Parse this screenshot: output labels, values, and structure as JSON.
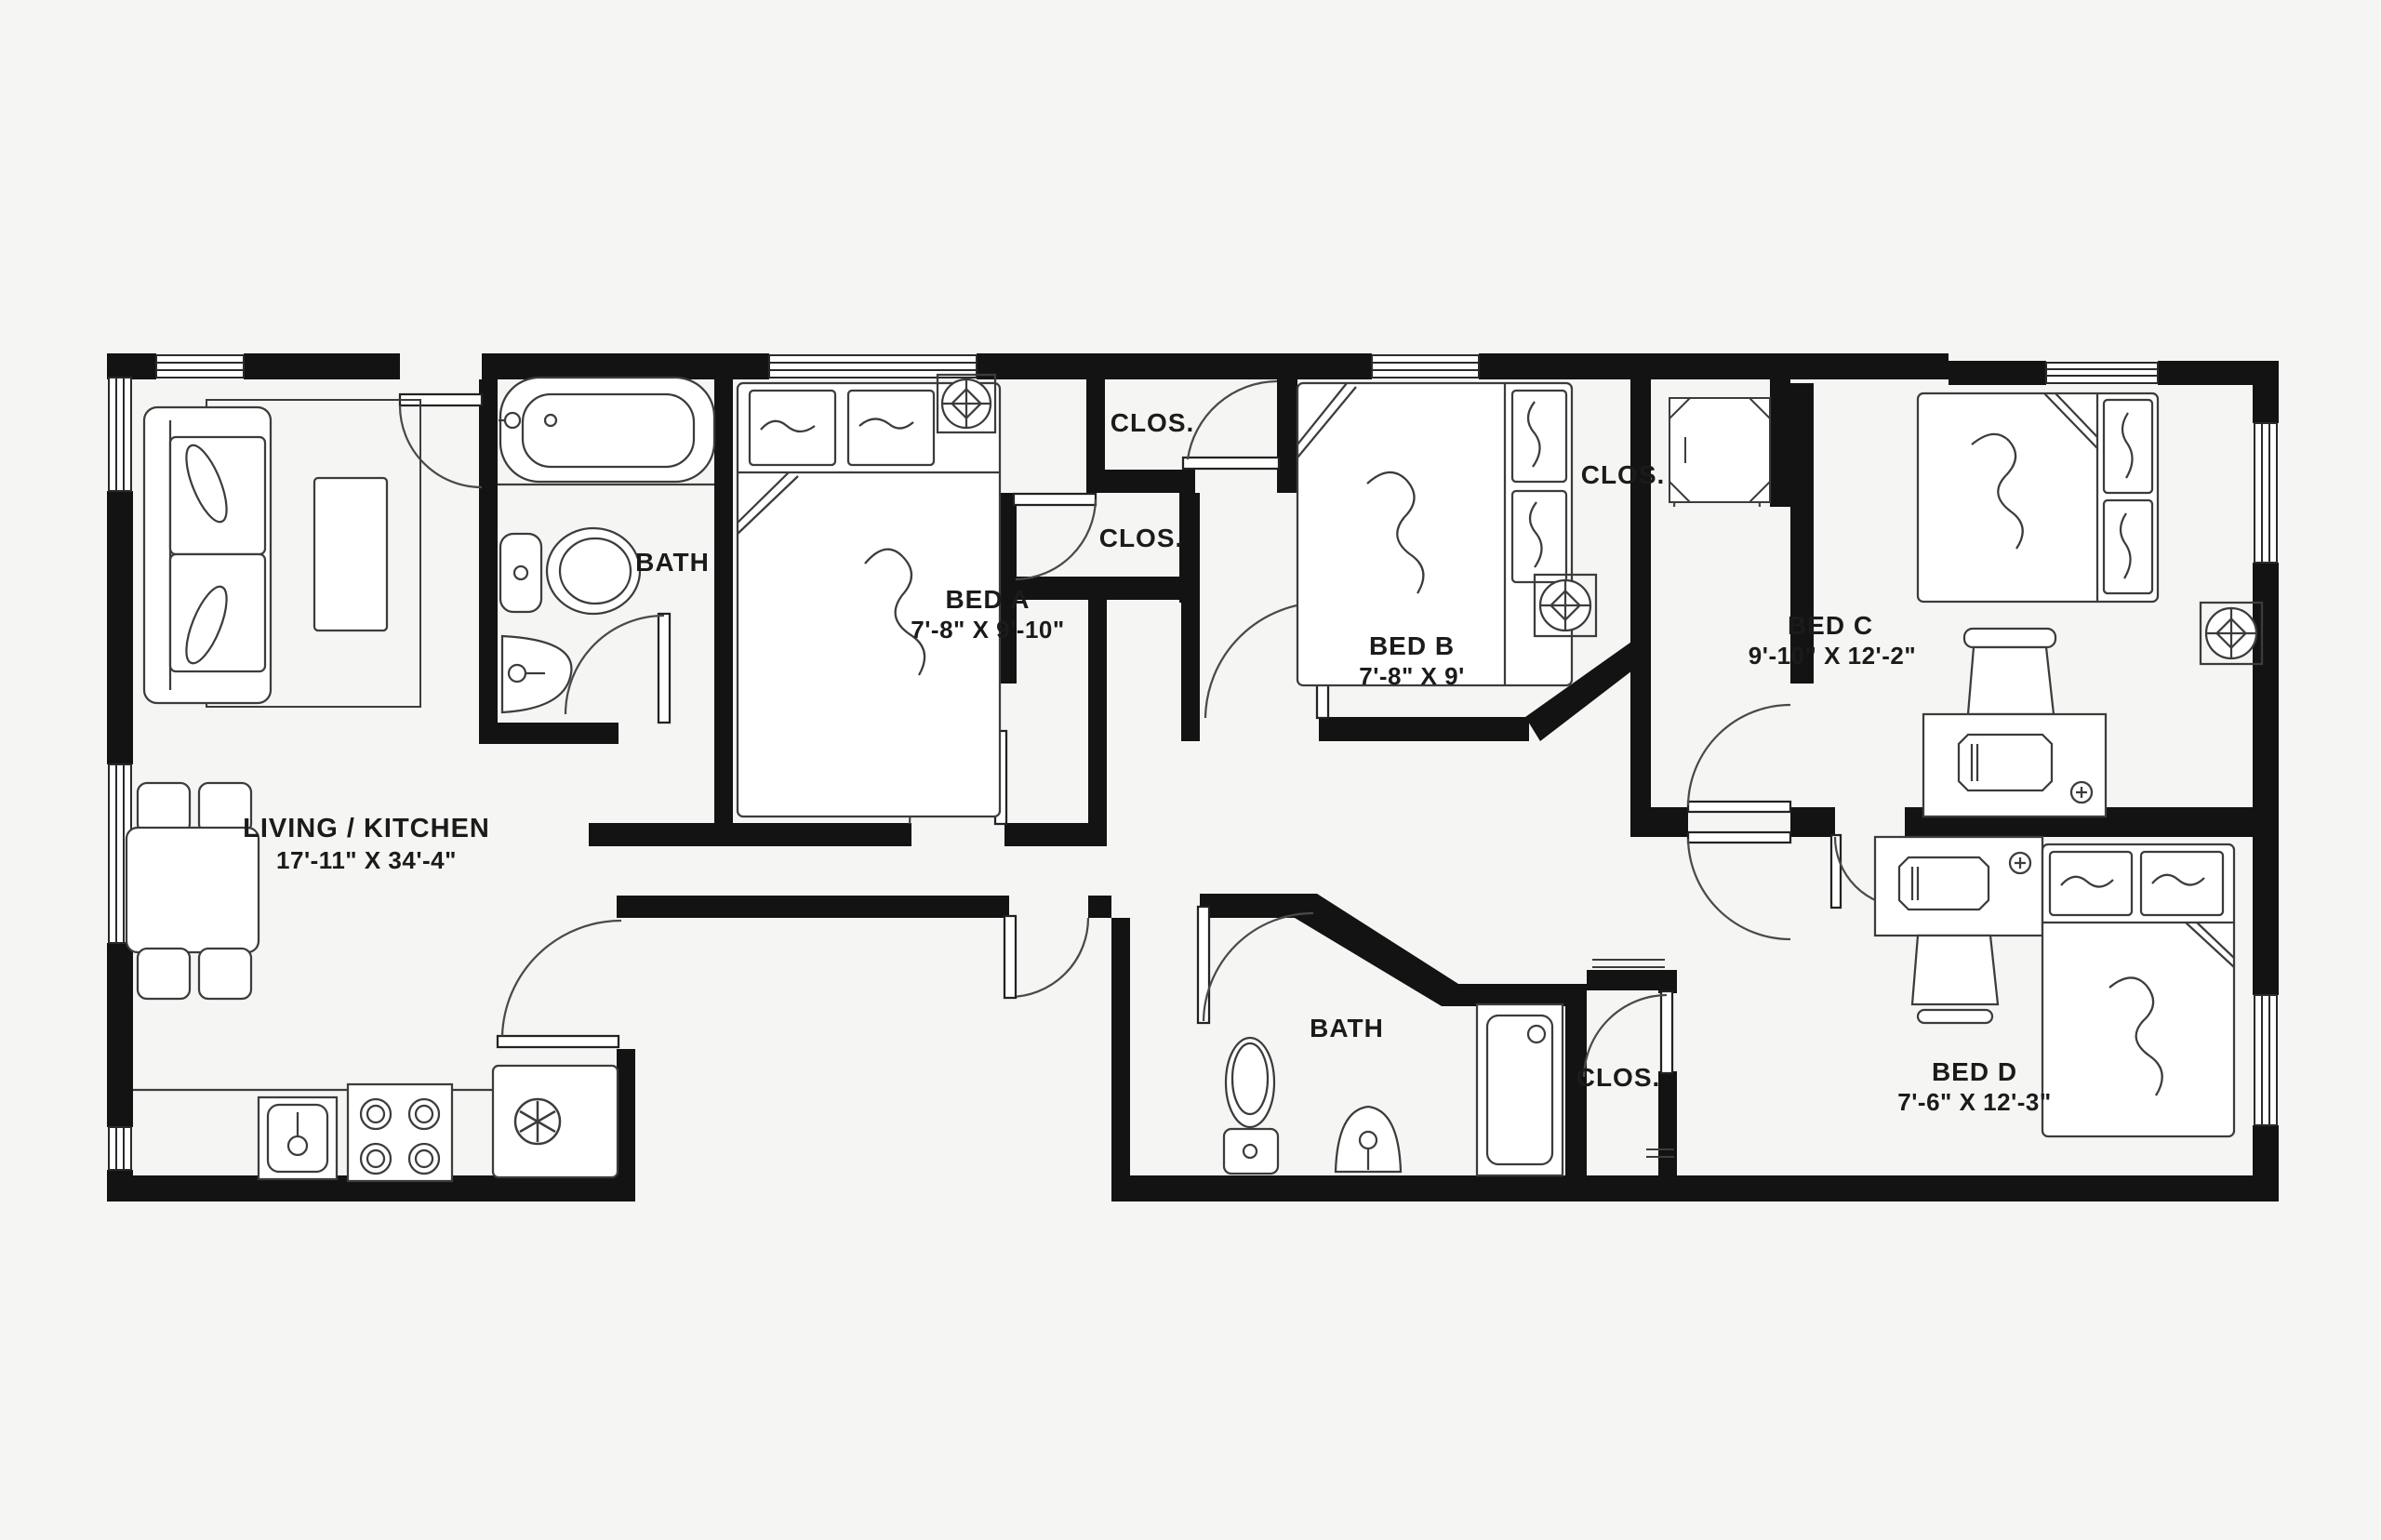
{
  "plan": {
    "title": "4-bedroom unit floor plan",
    "rooms": [
      {
        "name": "LIVING / KITCHEN",
        "dims": "17'-11\" X 34'-4\""
      },
      {
        "name": "BATH",
        "dims": ""
      },
      {
        "name": "BED A",
        "dims": "7'-8\" X 9'-10\""
      },
      {
        "name": "CLOS.",
        "dims": ""
      },
      {
        "name": "CLOS.",
        "dims": ""
      },
      {
        "name": "BED B",
        "dims": "7'-8\" X 9'"
      },
      {
        "name": "CLOS.",
        "dims": ""
      },
      {
        "name": "BED C",
        "dims": "9'-10\" X 12'-2\""
      },
      {
        "name": "BATH",
        "dims": ""
      },
      {
        "name": "CLOS.",
        "dims": ""
      },
      {
        "name": "BED D",
        "dims": "7'-6\" X 12'-3\""
      }
    ],
    "colors": {
      "wall": "#131313",
      "furniture_line": "#3c3c3c",
      "background": "#f5f5f3"
    }
  }
}
